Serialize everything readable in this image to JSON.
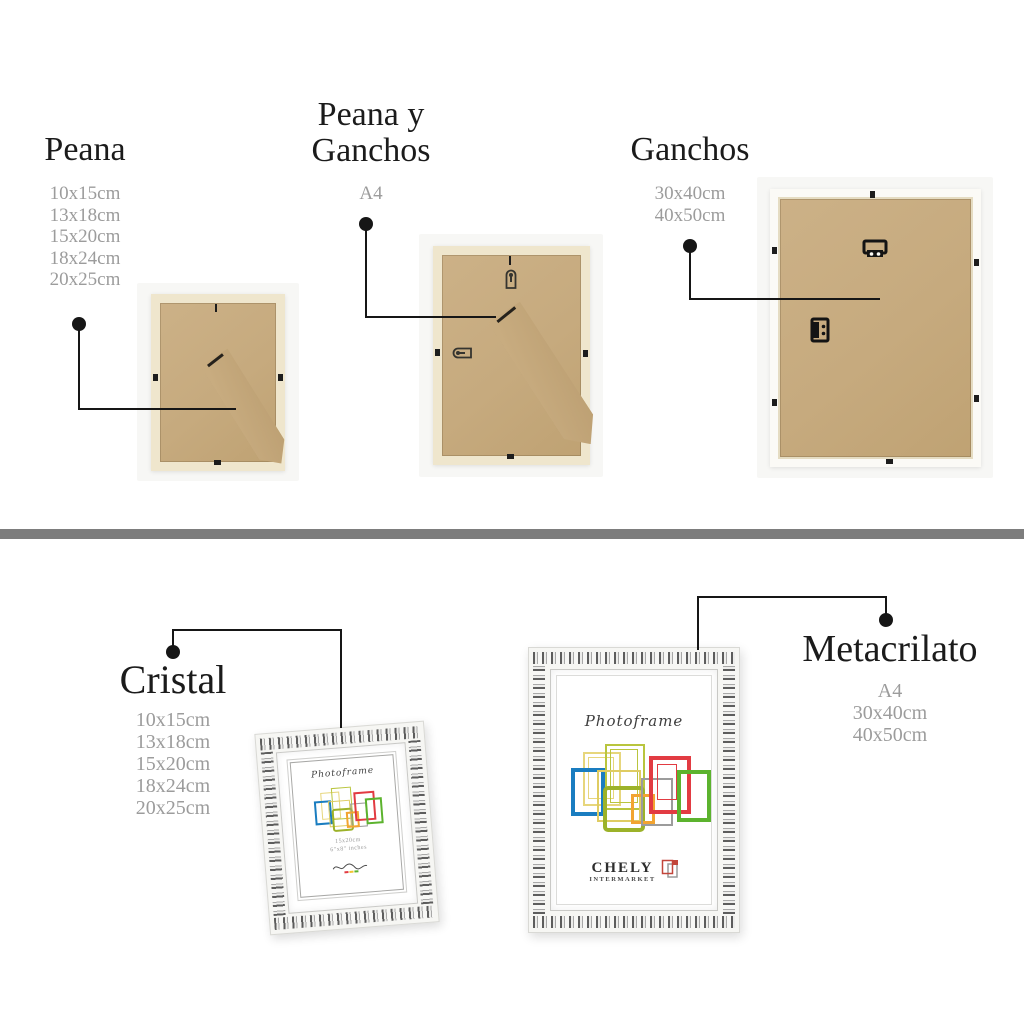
{
  "sections": {
    "peana": {
      "title": "Peana",
      "sizes": [
        "10x15cm",
        "13x18cm",
        "15x20cm",
        "18x24cm",
        "20x25cm"
      ]
    },
    "peana_y_ganchos": {
      "title_line1": "Peana y",
      "title_line2": "Ganchos",
      "sizes": [
        "A4"
      ]
    },
    "ganchos": {
      "title": "Ganchos",
      "sizes": [
        "30x40cm",
        "40x50cm"
      ]
    },
    "cristal": {
      "title": "Cristal",
      "sizes": [
        "10x15cm",
        "13x18cm",
        "15x20cm",
        "18x24cm",
        "20x25cm"
      ]
    },
    "metacrilato": {
      "title": "Metacrilato",
      "sizes": [
        "A4",
        "30x40cm",
        "40x50cm"
      ]
    }
  },
  "frame_insert": {
    "script_title": "Photoframe",
    "brand": "CHELY",
    "brand_sub": "INTERMARKET",
    "size_note_line1": "15x20cm",
    "size_note_line2": "6\"x8\" inches"
  },
  "colors": {
    "heading": "#1b1b1b",
    "size_text": "#9c9c9c",
    "callout": "#161616",
    "divider": "#7d7d7d",
    "mdf_back": "#c6aa7e",
    "cream_frame": "#efe6cd",
    "white_frame": "#fbfaf6",
    "easel_brown": "#5a3a26",
    "accent_blue": "#1a7dc0",
    "accent_red": "#e23b42",
    "accent_green": "#5cb32e",
    "accent_olive": "#9cb229",
    "accent_yellow": "#dfcc62",
    "accent_orange": "#f2a431",
    "brand_red": "#c2453a"
  }
}
